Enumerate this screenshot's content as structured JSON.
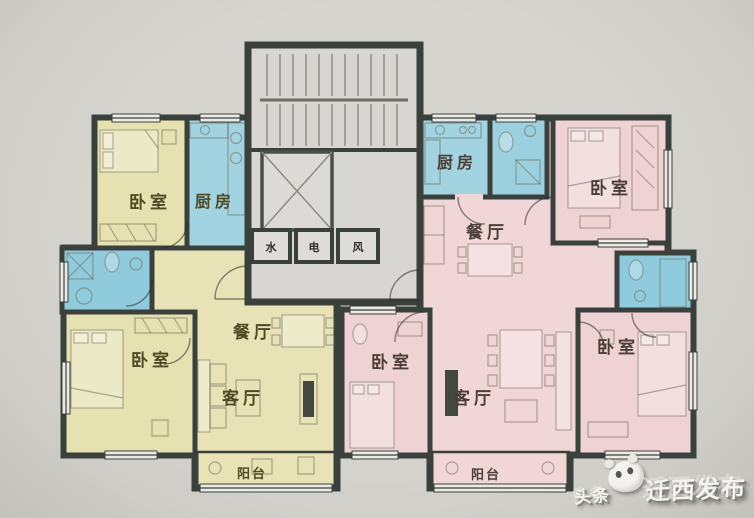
{
  "title": "apartment-floor-plan",
  "colors": {
    "paper": "#d2d0cb",
    "unit_left_fill": "#e7e3b6",
    "unit_right_fill": "#f1d6d8",
    "wet_room_fill": "#a2d3e0",
    "core_fill": "#d8d6d2",
    "wall": "#3a403c"
  },
  "core": {
    "shafts": [
      {
        "label": "水"
      },
      {
        "label": "电"
      },
      {
        "label": "风"
      }
    ]
  },
  "units": {
    "left": {
      "rooms": {
        "bedroom_top": {
          "label": "卧室"
        },
        "kitchen": {
          "label": "厨房"
        },
        "bedroom_bottom": {
          "label": "卧室"
        },
        "dining": {
          "label": "餐厅"
        },
        "living": {
          "label": "客厅"
        },
        "balcony": {
          "label": "阳台"
        }
      }
    },
    "right": {
      "rooms": {
        "kitchen": {
          "label": "厨房"
        },
        "bedroom_top": {
          "label": "卧室"
        },
        "dining": {
          "label": "餐厅"
        },
        "bedroom_middle": {
          "label": "卧室"
        },
        "living": {
          "label": "客厅"
        },
        "bedroom_bottom": {
          "label": "卧室"
        },
        "balcony": {
          "label": "阳台"
        }
      }
    }
  },
  "watermark": {
    "prefix": "头条",
    "logo": "panda-logo",
    "name": "迁西发布"
  }
}
